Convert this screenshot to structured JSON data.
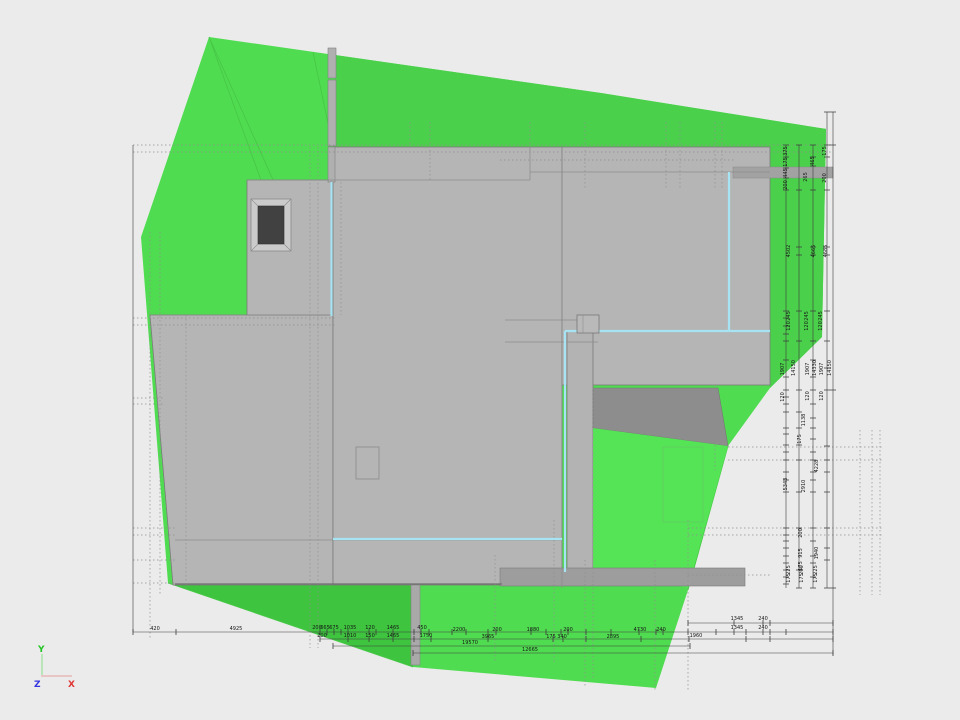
{
  "canvas": {
    "background": "#ebebeb"
  },
  "palette": {
    "terrain_green": "#50dc50",
    "terrain_green_muted": "#4bd04b",
    "terrain_green_dark": "#3ec43e",
    "terrain_green_bright": "#55e455",
    "building_gray": "#b5b5b5",
    "building_gray_dark": "#8d8d8d",
    "accent_cyan": "#a6e3f3",
    "dimension_line": "#3c3c3c",
    "axis_x_color": "#e03535",
    "axis_y_color": "#25c425",
    "axis_z_color": "#3535e0"
  },
  "axis_triad": {
    "x_label": "X",
    "y_label": "Y",
    "z_label": "Z"
  },
  "dimensions": {
    "bottom": [
      {
        "t": "420",
        "x": 155,
        "y": 630
      },
      {
        "t": "4925",
        "x": 236,
        "y": 630
      },
      {
        "t": "200",
        "x": 317,
        "y": 629
      },
      {
        "t": "665",
        "x": 325,
        "y": 629
      },
      {
        "t": "675",
        "x": 334,
        "y": 629
      },
      {
        "t": "1035",
        "x": 350,
        "y": 629
      },
      {
        "t": "120",
        "x": 370,
        "y": 629
      },
      {
        "t": "1465",
        "x": 393,
        "y": 629
      },
      {
        "t": "450",
        "x": 422,
        "y": 629
      },
      {
        "t": "2200",
        "x": 459,
        "y": 631
      },
      {
        "t": "200",
        "x": 497,
        "y": 631
      },
      {
        "t": "1880",
        "x": 533,
        "y": 631
      },
      {
        "t": "200",
        "x": 568,
        "y": 631
      },
      {
        "t": "4730",
        "x": 640,
        "y": 631
      },
      {
        "t": "240",
        "x": 661,
        "y": 631
      },
      {
        "t": "200",
        "x": 322,
        "y": 637
      },
      {
        "t": "1010",
        "x": 350,
        "y": 637
      },
      {
        "t": "150",
        "x": 370,
        "y": 637
      },
      {
        "t": "1465",
        "x": 393,
        "y": 637
      },
      {
        "t": "1750",
        "x": 426,
        "y": 637
      },
      {
        "t": "3965",
        "x": 488,
        "y": 638
      },
      {
        "t": "175",
        "x": 551,
        "y": 638
      },
      {
        "t": "340",
        "x": 562,
        "y": 638
      },
      {
        "t": "2895",
        "x": 613,
        "y": 638
      },
      {
        "t": "1960",
        "x": 696,
        "y": 637
      },
      {
        "t": "19570",
        "x": 470,
        "y": 644
      },
      {
        "t": "12665",
        "x": 530,
        "y": 651
      },
      {
        "t": "1345",
        "x": 737,
        "y": 620
      },
      {
        "t": "240",
        "x": 763,
        "y": 620
      },
      {
        "t": "1345",
        "x": 737,
        "y": 629
      },
      {
        "t": "240",
        "x": 763,
        "y": 629
      }
    ],
    "right": [
      {
        "t": "375",
        "x": 787,
        "y": 151
      },
      {
        "t": "175",
        "x": 787,
        "y": 162
      },
      {
        "t": "445",
        "x": 787,
        "y": 173
      },
      {
        "t": "200",
        "x": 787,
        "y": 185
      },
      {
        "t": "175",
        "x": 826,
        "y": 151
      },
      {
        "t": "465",
        "x": 814,
        "y": 161
      },
      {
        "t": "265",
        "x": 807,
        "y": 177
      },
      {
        "t": "200",
        "x": 826,
        "y": 178
      },
      {
        "t": "4502",
        "x": 790,
        "y": 251
      },
      {
        "t": "4665",
        "x": 815,
        "y": 251
      },
      {
        "t": "4685",
        "x": 827,
        "y": 251
      },
      {
        "t": "245",
        "x": 790,
        "y": 316
      },
      {
        "t": "120",
        "x": 790,
        "y": 326
      },
      {
        "t": "245",
        "x": 808,
        "y": 316
      },
      {
        "t": "120",
        "x": 808,
        "y": 326
      },
      {
        "t": "245",
        "x": 822,
        "y": 316
      },
      {
        "t": "120",
        "x": 822,
        "y": 326
      },
      {
        "t": "1907",
        "x": 784,
        "y": 369
      },
      {
        "t": "14150",
        "x": 795,
        "y": 368
      },
      {
        "t": "1907",
        "x": 809,
        "y": 369
      },
      {
        "t": "14330",
        "x": 816,
        "y": 368
      },
      {
        "t": "1907",
        "x": 823,
        "y": 369
      },
      {
        "t": "14150",
        "x": 831,
        "y": 368
      },
      {
        "t": "120",
        "x": 784,
        "y": 397
      },
      {
        "t": "120",
        "x": 809,
        "y": 396
      },
      {
        "t": "120",
        "x": 823,
        "y": 396
      },
      {
        "t": "1138",
        "x": 805,
        "y": 420
      },
      {
        "t": "175",
        "x": 801,
        "y": 439
      },
      {
        "t": "4228",
        "x": 818,
        "y": 466
      },
      {
        "t": "5343",
        "x": 787,
        "y": 484
      },
      {
        "t": "2910",
        "x": 805,
        "y": 486
      },
      {
        "t": "200",
        "x": 802,
        "y": 533
      },
      {
        "t": "915",
        "x": 802,
        "y": 553
      },
      {
        "t": "1940",
        "x": 818,
        "y": 553
      },
      {
        "t": "175",
        "x": 802,
        "y": 566
      },
      {
        "t": "225",
        "x": 790,
        "y": 570
      },
      {
        "t": "175",
        "x": 790,
        "y": 578
      },
      {
        "t": "200",
        "x": 803,
        "y": 570
      },
      {
        "t": "175",
        "x": 803,
        "y": 578
      },
      {
        "t": "225",
        "x": 817,
        "y": 570
      },
      {
        "t": "175",
        "x": 817,
        "y": 578
      }
    ]
  }
}
